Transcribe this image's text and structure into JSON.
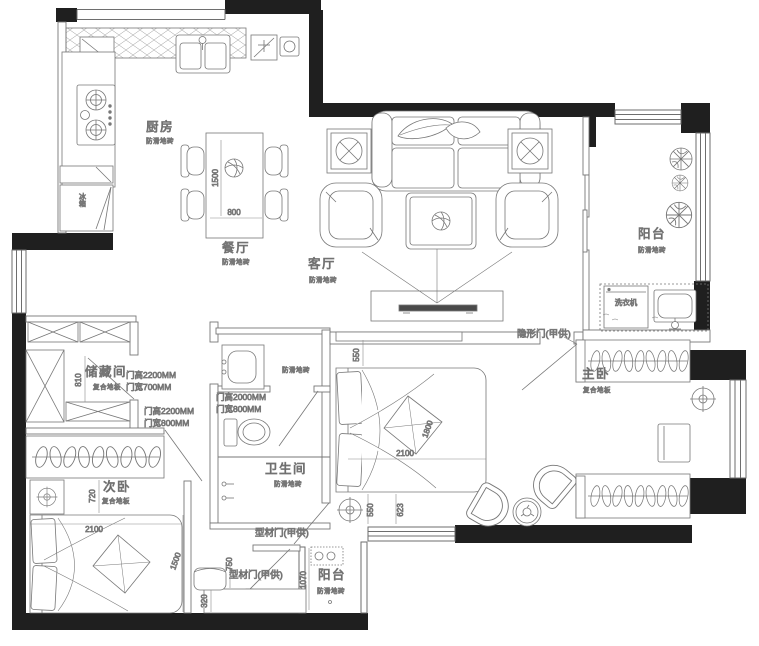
{
  "colors": {
    "wall": "#1f1f1f",
    "line": "#6e6e6e",
    "line_dark": "#454545",
    "tv": "#4a4a4a"
  },
  "rooms": {
    "kitchen": {
      "name": "厨房",
      "floor": "防滑地砖"
    },
    "dining": {
      "name": "餐厅",
      "floor": "防滑地砖"
    },
    "living": {
      "name": "客厅",
      "floor": "防滑地砖"
    },
    "balcony_right": {
      "name": "阳台",
      "floor": "防滑地砖"
    },
    "balcony_bottom": {
      "name": "阳台",
      "floor": "防滑地砖"
    },
    "master": {
      "name": "主卧",
      "floor": "复合地板"
    },
    "second": {
      "name": "次卧",
      "floor": "复合地板"
    },
    "storage": {
      "name": "储藏间",
      "floor": "复合地板"
    },
    "bath": {
      "name": "卫生间",
      "floor": "防滑地砖"
    },
    "vanity": {
      "floor": "防滑地砖"
    }
  },
  "appliances": {
    "washer": "洗衣机",
    "fridge": "冰箱"
  },
  "doors": {
    "hidden": "隐形门(甲供)",
    "profile_master": "型材门(甲供)",
    "profile_balcony": "型材门(甲供)",
    "storage_h": "门高2200MM",
    "storage_w": "门宽700MM",
    "second_h": "门高2200MM",
    "second_w": "门宽800MM",
    "bath_h": "门高2000MM",
    "bath_w": "门宽800MM"
  },
  "dims": {
    "dining_table_len": "1500",
    "dining_table_wid": "800",
    "storage_depth": "810",
    "second_clear": "720",
    "second_bed_len": "2100",
    "second_bed_wid": "1500",
    "master_head": "550",
    "master_bed_len": "2100",
    "master_bed_wid": "1800",
    "master_foot": "550",
    "master_clear": "623",
    "balcony_depth": "1070",
    "cabinet_depth": "320",
    "chair_width": "750"
  }
}
